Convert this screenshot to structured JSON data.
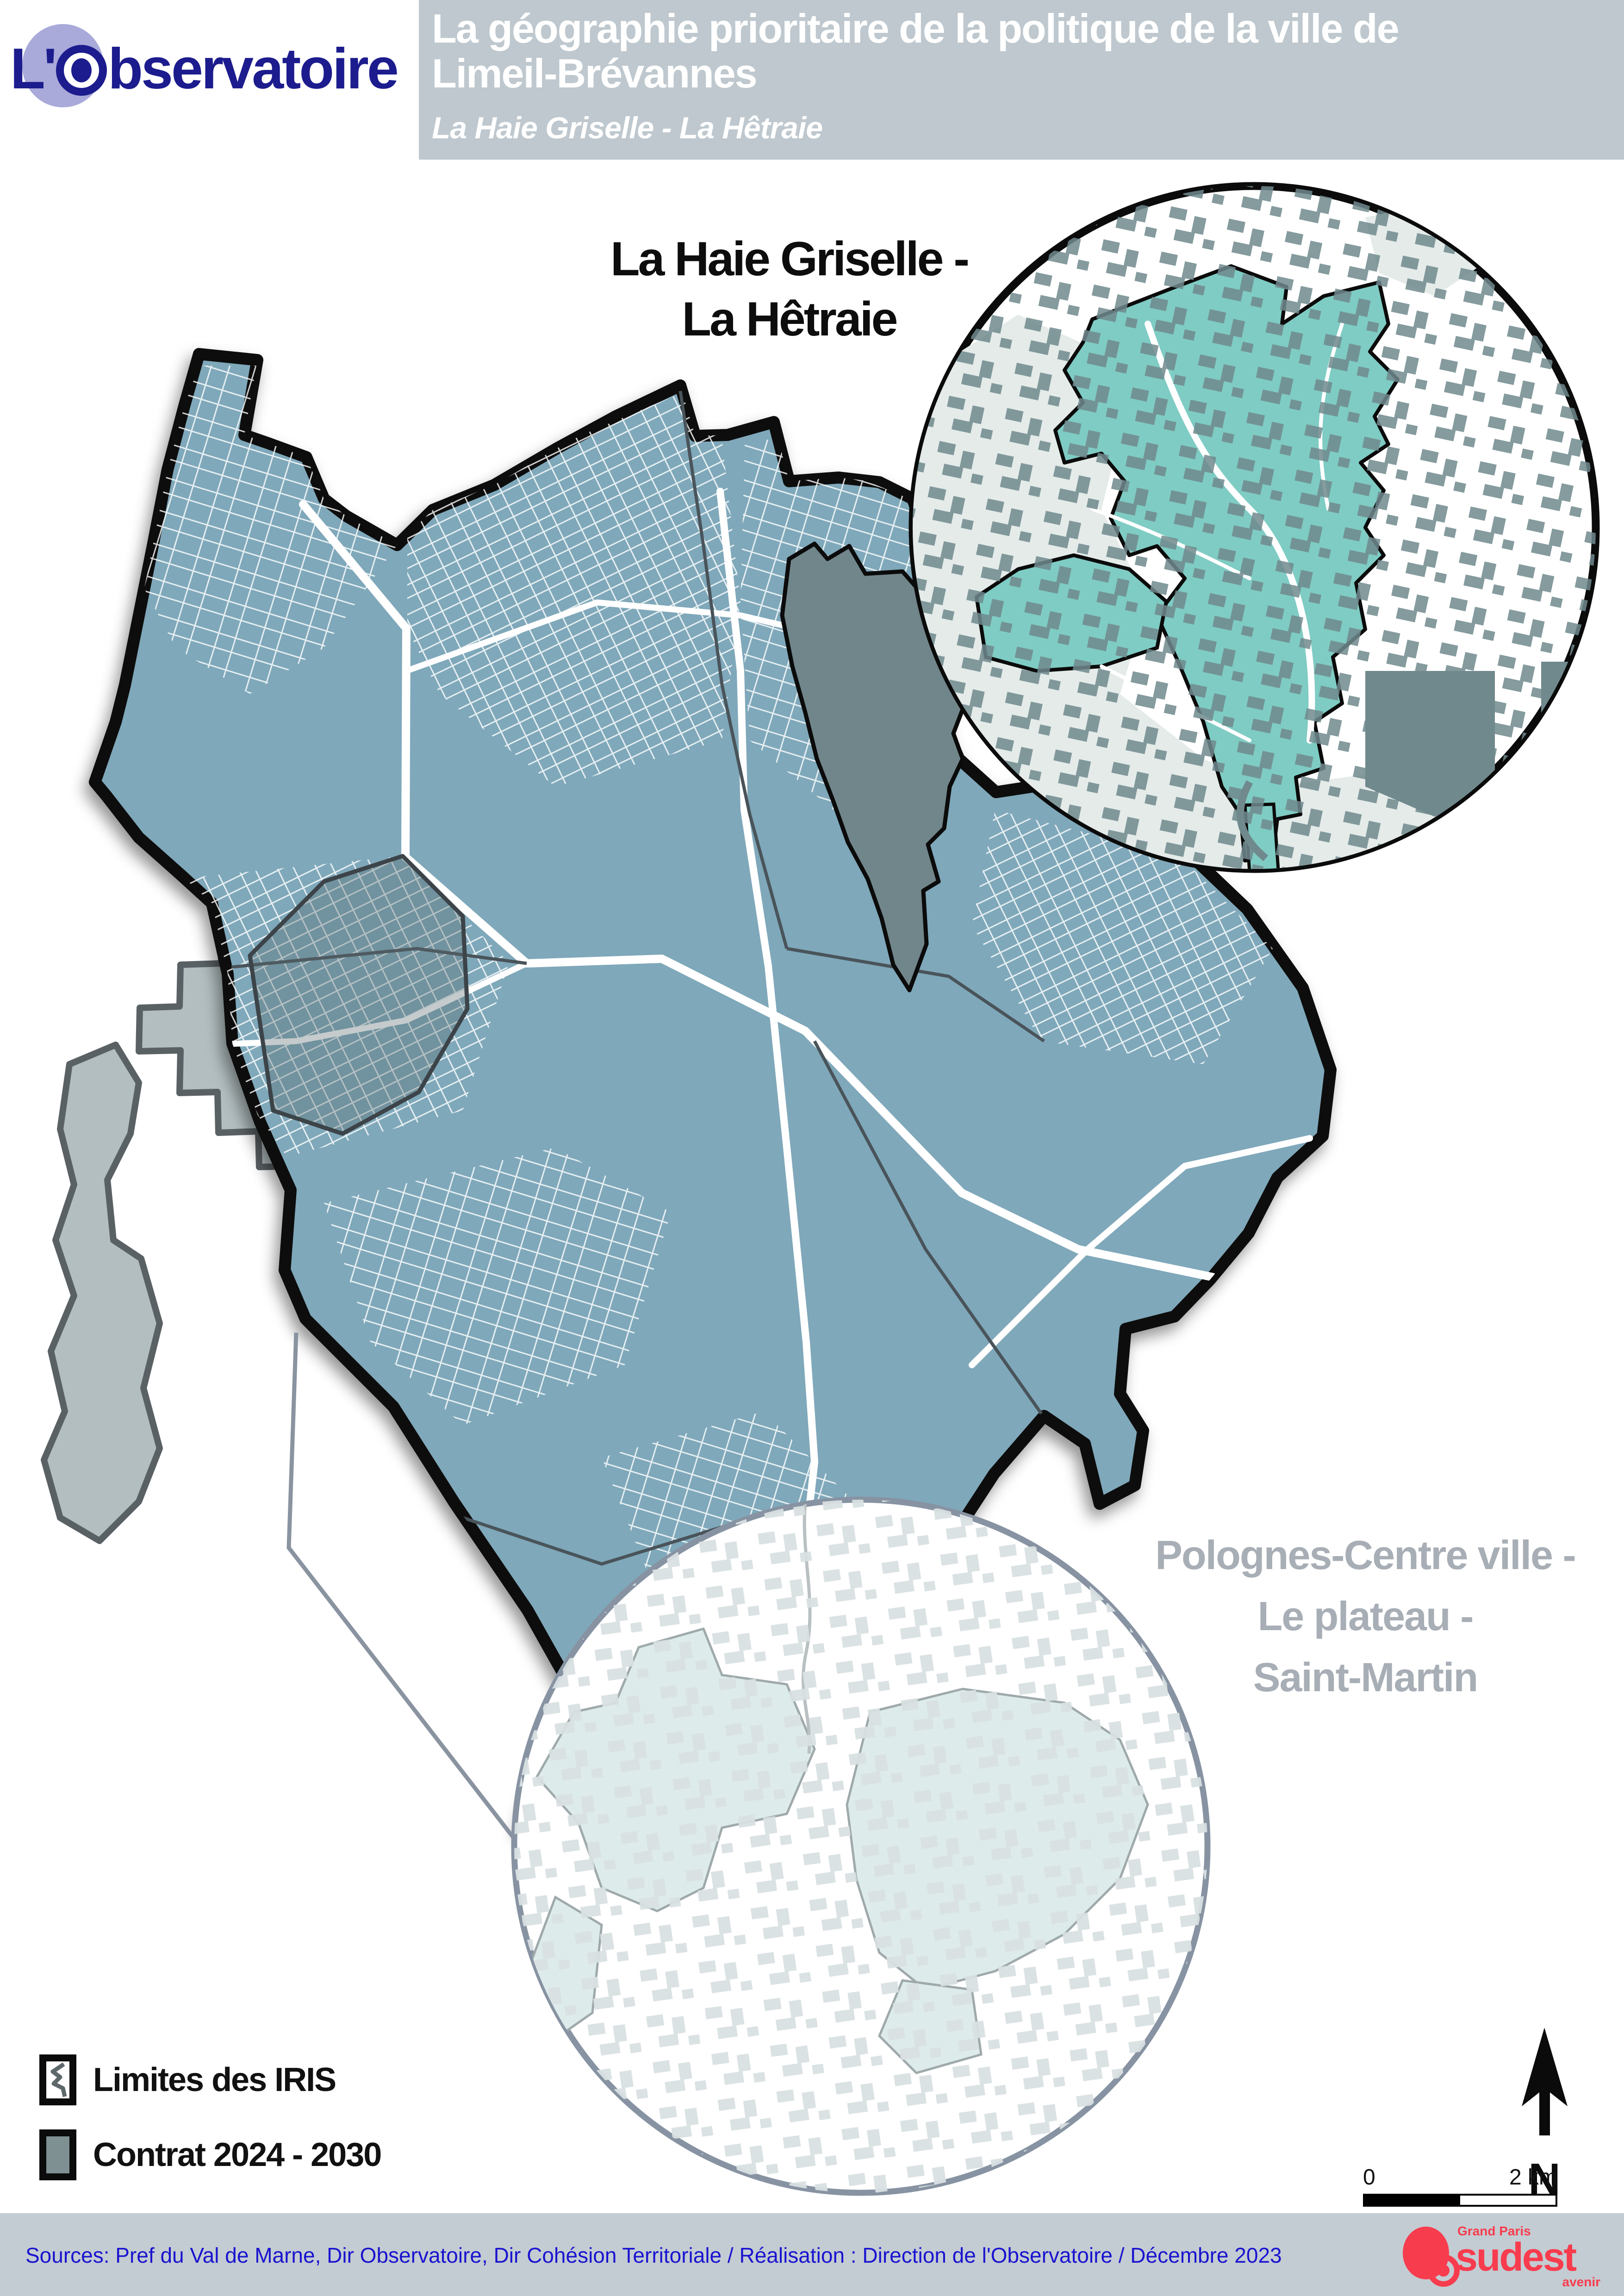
{
  "logo": {
    "prefix": "L'",
    "suffix": "bservatoire"
  },
  "header": {
    "title_line1": "La géographie prioritaire de la politique de la ville de",
    "title_line2": "Limeil-Brévannes",
    "subtitle": "La Haie Griselle - La Hêtraie"
  },
  "inset_top": {
    "label_line1": "La Haie Griselle -",
    "label_line2": "La Hêtraie"
  },
  "inset_bottom": {
    "label_line1": "Polognes-Centre ville -",
    "label_line2": "Le plateau -",
    "label_line3": "Saint-Martin"
  },
  "legend": {
    "iris_label": "Limites des IRIS",
    "contract_label": "Contrat 2024 - 2030"
  },
  "compass": {
    "north_label": "N"
  },
  "scalebar": {
    "start_label": "0",
    "end_label": "2 km"
  },
  "footer": {
    "sources": "Sources: Pref du Val de Marne, Dir Observatoire, Dir Cohésion Territoriale / Réalisation : Direction de l'Observatoire / Décembre 2023"
  },
  "brand": {
    "region": "Grand Paris",
    "name": "sudest",
    "tagline": "avenir"
  },
  "colors": {
    "header_band": "#bec8ce",
    "footer_band": "#c3ccd2",
    "footer_text": "#1a13cf",
    "logo_navy": "#1c1c8e",
    "logo_lavender": "#a9a9da",
    "map_fill": "#7fa8ba",
    "map_outline": "#0b0b0b",
    "contract_gray": "#71868a",
    "neighbor_gray": "#b2bec0",
    "neighbor_border": "#5a6164",
    "qpv_teal": "#7fccc4",
    "building_gray": "#70898d",
    "light_zone": "#e4ebe9",
    "inset_bottom_teal": "#ddecea",
    "inset_bottom_border": "#8793a2",
    "iris_line": "#49545a",
    "brand_red": "#f73c4e"
  }
}
